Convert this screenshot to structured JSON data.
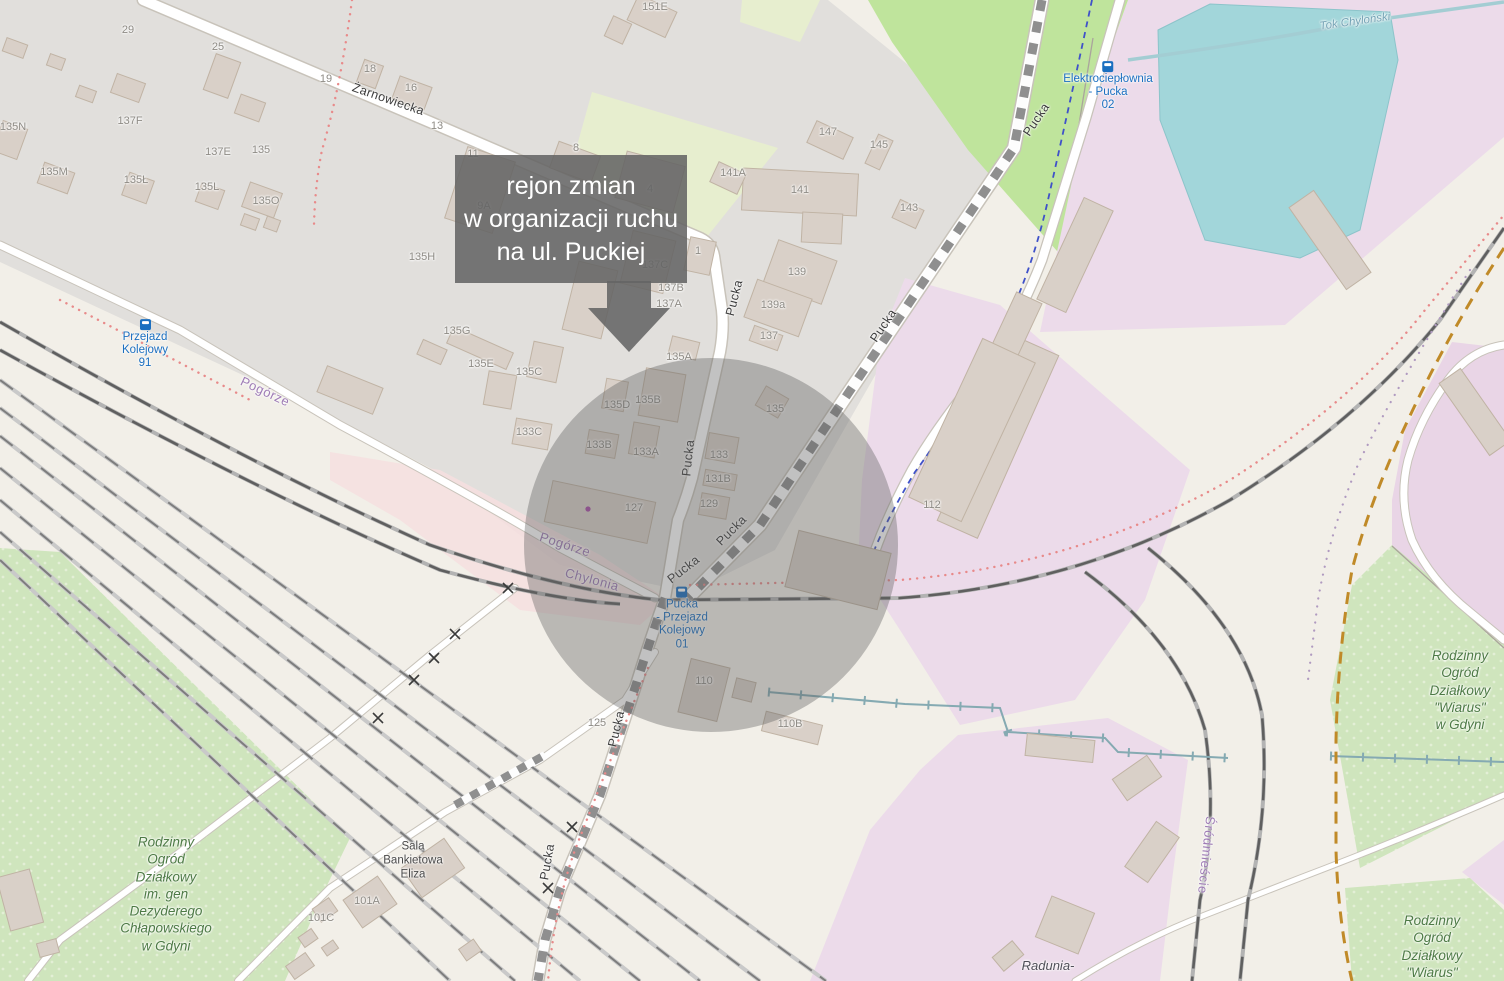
{
  "annotation": {
    "lines": [
      "rejon zmian",
      "w organizacji ruchu",
      "na ul. Puckiej"
    ]
  },
  "streets": [
    {
      "text": "Żarnowiecka",
      "x": 388,
      "y": 100,
      "rot": 19
    },
    {
      "text": "Pucka",
      "x": 735,
      "y": 298,
      "rot": -76
    },
    {
      "text": "Pucka",
      "x": 884,
      "y": 326,
      "rot": -56
    },
    {
      "text": "Pucka",
      "x": 1037,
      "y": 120,
      "rot": -56
    },
    {
      "text": "Pucka",
      "x": 689,
      "y": 458,
      "rot": -84
    },
    {
      "text": "Pucka",
      "x": 732,
      "y": 531,
      "rot": -45
    },
    {
      "text": "Pucka",
      "x": 684,
      "y": 570,
      "rot": -38
    },
    {
      "text": "Pucka",
      "x": 617,
      "y": 729,
      "rot": -77
    },
    {
      "text": "Pucka",
      "x": 548,
      "y": 862,
      "rot": -80
    }
  ],
  "districts": [
    {
      "text": "Pogórze",
      "x": 265,
      "y": 392,
      "rot": 25
    },
    {
      "text": "Pogórze",
      "x": 565,
      "y": 545,
      "rot": 18
    },
    {
      "text": "Chylonia",
      "x": 592,
      "y": 580,
      "rot": 15
    },
    {
      "text": "Śródmieście",
      "x": 1206,
      "y": 855,
      "rot": 96
    }
  ],
  "water_labels": [
    {
      "text": "Tok Chyloński",
      "x": 1355,
      "y": 22,
      "rot": -8
    }
  ],
  "transit_stops": [
    {
      "lines": [
        "Przejazd",
        "Kolejowy",
        "91"
      ],
      "x": 145,
      "y": 345
    },
    {
      "lines": [
        "Elektrociepłownia",
        "- Pucka",
        "02"
      ],
      "x": 1108,
      "y": 87
    },
    {
      "lines": [
        "Pucka",
        "- Przejazd",
        "Kolejowy",
        "01"
      ],
      "x": 682,
      "y": 619
    }
  ],
  "pois": [
    {
      "lines": [
        "Sala",
        "Bankietowa",
        "Eliza"
      ],
      "x": 413,
      "y": 861,
      "style": "plain"
    },
    {
      "lines": [
        "Radunia-"
      ],
      "x": 1048,
      "y": 966,
      "style": "italic"
    }
  ],
  "allotments": [
    {
      "lines": [
        "Rodzinny",
        "Ogród",
        "Działkowy",
        "im. gen",
        "Dezyderego",
        "Chłapowskiego",
        "w Gdyni"
      ],
      "x": 166,
      "y": 894
    },
    {
      "lines": [
        "Rodzinny",
        "Ogród",
        "Działkowy",
        "\"Wiarus\"",
        "w Gdyni"
      ],
      "x": 1460,
      "y": 690
    },
    {
      "lines": [
        "Rodzinny",
        "Ogród",
        "Działkowy",
        "\"Wiarus\"",
        "w Gdyni"
      ],
      "x": 1432,
      "y": 955
    }
  ],
  "house_numbers": [
    {
      "text": "29",
      "x": 128,
      "y": 31
    },
    {
      "text": "25",
      "x": 218,
      "y": 48
    },
    {
      "text": "19",
      "x": 326,
      "y": 80
    },
    {
      "text": "18",
      "x": 370,
      "y": 70
    },
    {
      "text": "16",
      "x": 411,
      "y": 89
    },
    {
      "text": "13",
      "x": 437,
      "y": 127
    },
    {
      "text": "137F",
      "x": 130,
      "y": 122
    },
    {
      "text": "137E",
      "x": 218,
      "y": 153
    },
    {
      "text": "135",
      "x": 261,
      "y": 151
    },
    {
      "text": "135N",
      "x": 13,
      "y": 128
    },
    {
      "text": "135M",
      "x": 54,
      "y": 173
    },
    {
      "text": "135Ł",
      "x": 136,
      "y": 181
    },
    {
      "text": "135L",
      "x": 207,
      "y": 188
    },
    {
      "text": "135O",
      "x": 266,
      "y": 202
    },
    {
      "text": "135H",
      "x": 422,
      "y": 258
    },
    {
      "text": "151E",
      "x": 655,
      "y": 8
    },
    {
      "text": "147",
      "x": 828,
      "y": 133
    },
    {
      "text": "145",
      "x": 879,
      "y": 146
    },
    {
      "text": "141A",
      "x": 733,
      "y": 174
    },
    {
      "text": "141",
      "x": 800,
      "y": 191
    },
    {
      "text": "143",
      "x": 909,
      "y": 209
    },
    {
      "text": "11",
      "x": 473,
      "y": 155
    },
    {
      "text": "8",
      "x": 576,
      "y": 149
    },
    {
      "text": "9A",
      "x": 484,
      "y": 207
    },
    {
      "text": "4",
      "x": 650,
      "y": 190
    },
    {
      "text": "1",
      "x": 698,
      "y": 252
    },
    {
      "text": "137C",
      "x": 655,
      "y": 266
    },
    {
      "text": "137B",
      "x": 671,
      "y": 289
    },
    {
      "text": "137A",
      "x": 669,
      "y": 305
    },
    {
      "text": "139",
      "x": 797,
      "y": 273
    },
    {
      "text": "139a",
      "x": 773,
      "y": 306
    },
    {
      "text": "137",
      "x": 769,
      "y": 337
    },
    {
      "text": "135A",
      "x": 679,
      "y": 358
    },
    {
      "text": "135G",
      "x": 457,
      "y": 332
    },
    {
      "text": "135E",
      "x": 481,
      "y": 365
    },
    {
      "text": "135C",
      "x": 529,
      "y": 373
    },
    {
      "text": "135D",
      "x": 617,
      "y": 406
    },
    {
      "text": "135B",
      "x": 648,
      "y": 401
    },
    {
      "text": "133C",
      "x": 529,
      "y": 433
    },
    {
      "text": "133B",
      "x": 599,
      "y": 446
    },
    {
      "text": "133A",
      "x": 646,
      "y": 453
    },
    {
      "text": "133",
      "x": 719,
      "y": 456
    },
    {
      "text": "131B",
      "x": 718,
      "y": 480
    },
    {
      "text": "129",
      "x": 709,
      "y": 505
    },
    {
      "text": "127",
      "x": 634,
      "y": 509
    },
    {
      "text": "135",
      "x": 775,
      "y": 410
    },
    {
      "text": "112",
      "x": 932,
      "y": 506
    },
    {
      "text": "110",
      "x": 704,
      "y": 682
    },
    {
      "text": "110B",
      "x": 790,
      "y": 725
    },
    {
      "text": "125",
      "x": 597,
      "y": 724
    },
    {
      "text": "101A",
      "x": 367,
      "y": 902
    },
    {
      "text": "101C",
      "x": 321,
      "y": 919
    }
  ],
  "colors": {
    "base": "#f2efe8",
    "residential_gray": "#e1dfdc",
    "industrial_pink": "#ecdbea",
    "industrial_pink_dark": "#e9d5e6",
    "pink_strip": "#f6dfdf",
    "green_field": "#bfe49c",
    "scrub": "#e7eecf",
    "allotment": "#cfe5bd",
    "water": "#a2d6da",
    "building": "#d9d0c8",
    "rail_dark": "#5f5f5f",
    "red_dots": "#e88a8a",
    "blue_route": "#3f51c9",
    "boundary_orange": "#c08a28",
    "boundary_purple": "#b09ac0",
    "transit_blue": "#1a6fc0",
    "overlay_gray": "#646464"
  }
}
